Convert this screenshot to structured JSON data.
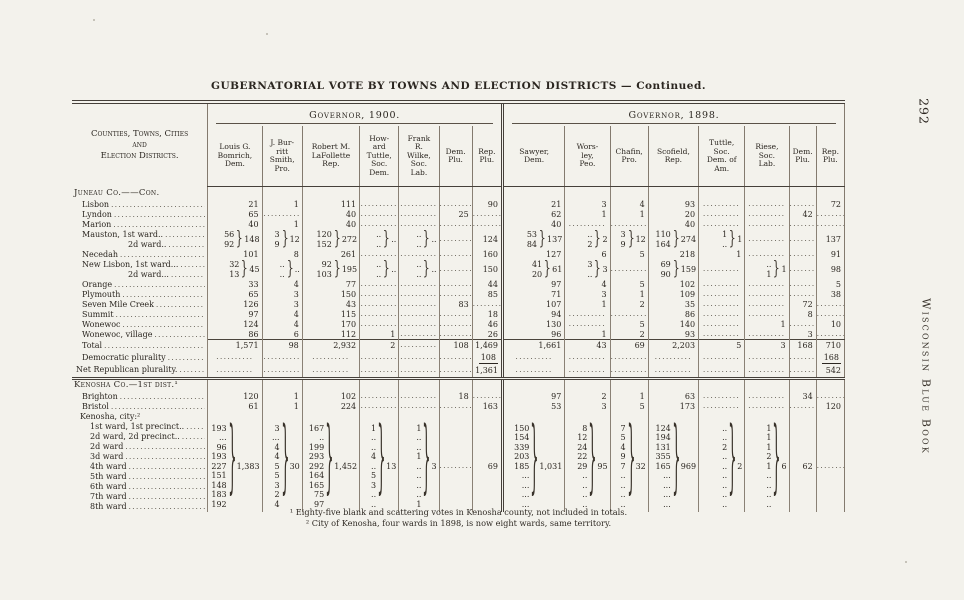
{
  "page": {
    "title": "GUBERNATORIAL VOTE BY TOWNS AND ELECTION DISTRICTS — Continued.",
    "page_number": "292",
    "side_text": "Wisconsin Blue Book",
    "footnotes": [
      "¹ Eighty-five blank and scattering votes in Kenosha county, not included in totals.",
      "² City of Kenosha, four wards in 1898, is now eight wards, same territory."
    ],
    "ink_color": "#2b2620",
    "paper_color": "#f3f2ec",
    "rule_color": "#45403a"
  },
  "table": {
    "stub_header": "Counties, Towns, Cities\nand\nElection Districts.",
    "groups": [
      {
        "label": "Governor, 1900.",
        "columns": [
          "Louis G.\nBomrich,\nDem.",
          "J. Bur-\nritt\nSmith,\nPro.",
          "Robert M.\nLaFollette\nRep.",
          "How-\nard\nTuttle,\nSoc.\nDem.",
          "Frank\nR.\nWilke,\nSoc.\nLab.",
          "Dem.\nPlu.",
          "Rep.\nPlu."
        ]
      },
      {
        "label": "Governor, 1898.",
        "columns": [
          "Sawyer,\nDem.",
          "Wors-\nley,\nPeo.",
          "Chafin,\nPro.",
          "Scofield,\nRep.",
          "Tuttle,\nSoc.\nDem. of\nAm.",
          "Riese,\nSoc.\nLab.",
          "Dem.\nPlu.",
          "Rep.\nPlu."
        ]
      }
    ],
    "rows": [
      {
        "type": "section",
        "label": "Juneau Co.——Con."
      },
      {
        "type": "town",
        "label": "Lisbon",
        "cells": [
          "21",
          "1",
          "111",
          "~",
          "~",
          "~",
          "90",
          "21",
          "3",
          "4",
          "93",
          "~",
          "~",
          "~",
          "72"
        ]
      },
      {
        "type": "town",
        "label": "Lyndon",
        "cells": [
          "65",
          "~",
          "40",
          "~",
          "~",
          "25",
          "~",
          "62",
          "1",
          "1",
          "20",
          "~",
          "~",
          "42",
          "~"
        ]
      },
      {
        "type": "town",
        "label": "Marion",
        "cells": [
          "40",
          "1",
          "40",
          "~",
          "~",
          "~",
          "~",
          "40",
          "~",
          "~",
          "40",
          "~",
          "~",
          "~",
          "~"
        ]
      },
      {
        "type": "town",
        "label": "Mauston, 1st ward..",
        "cells": [
          {
            "vals": [
              "56",
              "92"
            ],
            "total": "148"
          },
          {
            "vals": [
              "3",
              "9"
            ],
            "total": "12"
          },
          {
            "vals": [
              "120",
              "152"
            ],
            "total": "272"
          },
          {
            "vals": [
              "..",
              ".."
            ],
            "total": ".."
          },
          {
            "vals": [
              "..",
              ".."
            ],
            "total": ".."
          },
          {
            "rows": 2,
            "v": "~"
          },
          {
            "rows": 2,
            "v": "124"
          },
          {
            "vals": [
              "53",
              "84"
            ],
            "total": "137"
          },
          {
            "vals": [
              "..",
              "2"
            ],
            "total": "2"
          },
          {
            "vals": [
              "3",
              "9"
            ],
            "total": "12"
          },
          {
            "vals": [
              "110",
              "164"
            ],
            "total": "274"
          },
          {
            "vals": [
              "1",
              ".."
            ],
            "total": "1"
          },
          {
            "rows": 2,
            "v": "~"
          },
          {
            "rows": 2,
            "v": "~"
          },
          {
            "rows": 2,
            "v": "137"
          }
        ]
      },
      {
        "type": "ward2",
        "label": "2d ward..",
        "cells": [
          null,
          null,
          null,
          null,
          null,
          null,
          null,
          null,
          null,
          null,
          null,
          null,
          null,
          null,
          null
        ]
      },
      {
        "type": "town",
        "label": "Necedah",
        "cells": [
          "101",
          "8",
          "261",
          "~",
          "~",
          "~",
          "160",
          "127",
          "6",
          "5",
          "218",
          "1",
          "~",
          "~",
          "91"
        ]
      },
      {
        "type": "town",
        "label": "New Lisbon, 1st ward...",
        "cells": [
          {
            "vals": [
              "32",
              "13"
            ],
            "total": "45"
          },
          {
            "vals": [
              "..",
              ".."
            ],
            "total": ".."
          },
          {
            "vals": [
              "92",
              "103"
            ],
            "total": "195"
          },
          {
            "vals": [
              "..",
              ".."
            ],
            "total": ".."
          },
          {
            "vals": [
              "..",
              ".."
            ],
            "total": ".."
          },
          {
            "rows": 2,
            "v": "~"
          },
          {
            "rows": 2,
            "v": "150"
          },
          {
            "vals": [
              "41",
              "20"
            ],
            "total": "61"
          },
          {
            "vals": [
              "3",
              ".."
            ],
            "total": "3"
          },
          {
            "rows": 2,
            "v": "~"
          },
          {
            "vals": [
              "69",
              "90"
            ],
            "total": "159"
          },
          {
            "rows": 2,
            "v": "~"
          },
          {
            "vals": [
              "..",
              "1"
            ],
            "total": "1"
          },
          {
            "rows": 2,
            "v": "~"
          },
          {
            "rows": 2,
            "v": "98"
          }
        ]
      },
      {
        "type": "ward2",
        "label": "2d ward...",
        "cells": [
          null,
          null,
          null,
          null,
          null,
          null,
          null,
          null,
          null,
          null,
          null,
          null,
          null,
          null,
          null
        ]
      },
      {
        "type": "town",
        "label": "Orange",
        "cells": [
          "33",
          "4",
          "77",
          "~",
          "~",
          "~",
          "44",
          "97",
          "4",
          "5",
          "102",
          "~",
          "~",
          "~",
          "5"
        ]
      },
      {
        "type": "town",
        "label": "Plymouth",
        "cells": [
          "65",
          "3",
          "150",
          "~",
          "~",
          "~",
          "85",
          "71",
          "3",
          "1",
          "109",
          "~",
          "~",
          "~",
          "38"
        ]
      },
      {
        "type": "town",
        "label": "Seven Mile Creek",
        "cells": [
          "126",
          "3",
          "43",
          "~",
          "~",
          "83",
          "~",
          "107",
          "1",
          "2",
          "35",
          "~",
          "~",
          "72",
          "~"
        ]
      },
      {
        "type": "town",
        "label": "Summit",
        "cells": [
          "97",
          "4",
          "115",
          "~",
          "~",
          "~",
          "18",
          "94",
          "~",
          "~",
          "86",
          "~",
          "~",
          "8",
          "~"
        ]
      },
      {
        "type": "town",
        "label": "Wonewoc",
        "cells": [
          "124",
          "4",
          "170",
          "~",
          "~",
          "~",
          "46",
          "130",
          "~",
          "5",
          "140",
          "~",
          "1",
          "~",
          "10"
        ]
      },
      {
        "type": "town",
        "label": "Wonewoc, village",
        "cells": [
          "86",
          "6",
          "112",
          "1",
          "~",
          "~",
          "26",
          "96",
          "1",
          "2",
          "93",
          "~",
          "~",
          "3",
          "~"
        ]
      },
      {
        "type": "total",
        "label": "Total",
        "cells": [
          "1,571",
          "98",
          "2,932",
          "2",
          "~",
          "108",
          "1,469",
          "1,661",
          "43",
          "69",
          "2,203",
          "5",
          "3",
          "168",
          "710"
        ]
      },
      {
        "type": "plur",
        "label": "Democratic plurality",
        "cells": [
          "~",
          "~",
          "~",
          "~",
          "~",
          "~",
          {
            "u": "108"
          },
          "~",
          "~",
          "~",
          "~",
          "~",
          "~",
          "~",
          {
            "u": "168"
          }
        ]
      },
      {
        "type": "netplur",
        "label": "Net Republican plurality.",
        "cells": [
          "~",
          "~",
          "~",
          "~",
          "~",
          "~",
          "1,361",
          "~",
          "~",
          "~",
          "~",
          "~",
          "~",
          "~",
          "542"
        ]
      },
      {
        "type": "section",
        "label": "Kenosha Co.—1st dist.¹"
      },
      {
        "type": "town",
        "label": "Brighton",
        "cells": [
          "120",
          "1",
          "102",
          "~",
          "~",
          "18",
          "~",
          "97",
          "2",
          "1",
          "63",
          "~",
          "~",
          "34",
          "~"
        ]
      },
      {
        "type": "town",
        "label": "Bristol",
        "cells": [
          "61",
          "1",
          "224",
          "~",
          "~",
          "~",
          "163",
          "53",
          "3",
          "5",
          "173",
          "~",
          "~",
          "~",
          "120"
        ]
      },
      {
        "type": "subsection",
        "label": "Kenosha, city:²"
      },
      {
        "type": "ward",
        "label": "1st ward, 1st precinct..",
        "cells": [
          {
            "vals": [
              "193",
              "...",
              "96",
              "193",
              "227",
              "151",
              "148",
              "183",
              "192"
            ],
            "total": "1,383"
          },
          {
            "vals": [
              "3",
              "...",
              "4",
              "4",
              "5",
              "5",
              "3",
              "2",
              "4"
            ],
            "total": "30"
          },
          {
            "vals": [
              "167",
              "..",
              "199",
              "293",
              "292",
              "164",
              "165",
              "75",
              "97"
            ],
            "total": "1,452"
          },
          {
            "vals": [
              "1",
              "..",
              "..",
              "4",
              "..",
              "5",
              "3",
              "..",
              ".."
            ],
            "total": "13"
          },
          {
            "vals": [
              "1",
              "..",
              "..",
              "1",
              "..",
              "..",
              "..",
              "..",
              "1"
            ],
            "total": "3"
          },
          {
            "rows": 9,
            "v": "~"
          },
          {
            "rows": 9,
            "v": "69"
          },
          {
            "vals": [
              "150",
              "154",
              "339",
              "203",
              "185",
              "...",
              "...",
              "...",
              "..."
            ],
            "total": "1,031"
          },
          {
            "vals": [
              "8",
              "12",
              "24",
              "22",
              "29",
              "..",
              "..",
              "..",
              ".."
            ],
            "total": "95"
          },
          {
            "vals": [
              "7",
              "5",
              "4",
              "9",
              "7",
              "..",
              "..",
              "..",
              ".."
            ],
            "total": "32"
          },
          {
            "vals": [
              "124",
              "194",
              "131",
              "355",
              "165",
              "...",
              "...",
              "...",
              "..."
            ],
            "total": "969"
          },
          {
            "vals": [
              "..",
              "..",
              "2",
              "..",
              "..",
              "..",
              "..",
              "..",
              ".."
            ],
            "total": "2"
          },
          {
            "vals": [
              "1",
              "1",
              "1",
              "2",
              "1",
              "..",
              "..",
              "..",
              ".."
            ],
            "total": "6"
          },
          {
            "rows": 9,
            "v": "62"
          },
          {
            "rows": 9,
            "v": "~"
          }
        ]
      },
      {
        "type": "ward",
        "label": "2d ward, 2d precinct..",
        "cells": [
          null,
          null,
          null,
          null,
          null,
          null,
          null,
          null,
          null,
          null,
          null,
          null,
          null,
          null,
          null
        ]
      },
      {
        "type": "ward",
        "label": "2d ward",
        "cells": [
          null,
          null,
          null,
          null,
          null,
          null,
          null,
          null,
          null,
          null,
          null,
          null,
          null,
          null,
          null
        ]
      },
      {
        "type": "ward",
        "label": "3d ward",
        "cells": [
          null,
          null,
          null,
          null,
          null,
          null,
          null,
          null,
          null,
          null,
          null,
          null,
          null,
          null,
          null
        ]
      },
      {
        "type": "ward",
        "label": "4th ward",
        "cells": [
          null,
          null,
          null,
          null,
          null,
          null,
          null,
          null,
          null,
          null,
          null,
          null,
          null,
          null,
          null
        ]
      },
      {
        "type": "ward",
        "label": "5th ward",
        "cells": [
          null,
          null,
          null,
          null,
          null,
          null,
          null,
          null,
          null,
          null,
          null,
          null,
          null,
          null,
          null
        ]
      },
      {
        "type": "ward",
        "label": "6th ward",
        "cells": [
          null,
          null,
          null,
          null,
          null,
          null,
          null,
          null,
          null,
          null,
          null,
          null,
          null,
          null,
          null
        ]
      },
      {
        "type": "ward",
        "label": "7th ward",
        "cells": [
          null,
          null,
          null,
          null,
          null,
          null,
          null,
          null,
          null,
          null,
          null,
          null,
          null,
          null,
          null
        ]
      },
      {
        "type": "ward",
        "label": "8th ward",
        "cells": [
          null,
          null,
          null,
          null,
          null,
          null,
          null,
          null,
          null,
          null,
          null,
          null,
          null,
          null,
          null
        ]
      }
    ]
  }
}
